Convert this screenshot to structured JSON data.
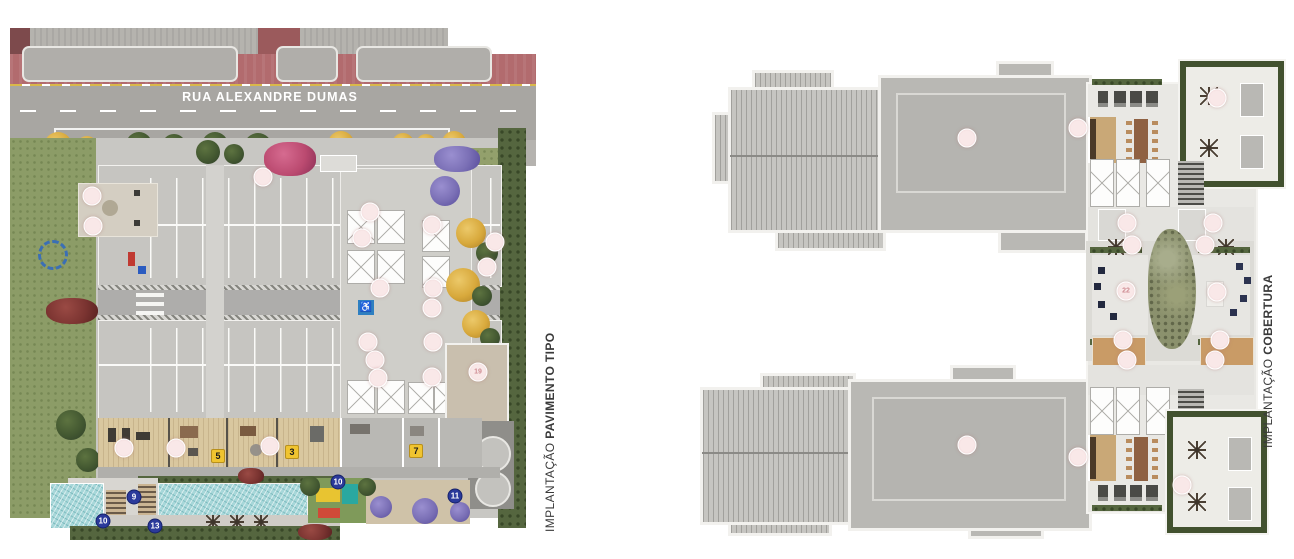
{
  "page": {
    "background": "#ffffff"
  },
  "left_plan": {
    "caption_regular": "IMPLANTAÇÃO",
    "caption_bold": "PAVIMENTO TIPO",
    "street_name": "RUA ALEXANDRE DUMAS",
    "markers": {
      "pink": [
        {
          "x": 82,
          "y": 168,
          "l": ""
        },
        {
          "x": 83,
          "y": 198,
          "l": ""
        },
        {
          "x": 253,
          "y": 149,
          "l": ""
        },
        {
          "x": 360,
          "y": 184,
          "l": ""
        },
        {
          "x": 352,
          "y": 210,
          "l": ""
        },
        {
          "x": 422,
          "y": 197,
          "l": ""
        },
        {
          "x": 485,
          "y": 214,
          "l": ""
        },
        {
          "x": 477,
          "y": 239,
          "l": ""
        },
        {
          "x": 370,
          "y": 260,
          "l": ""
        },
        {
          "x": 423,
          "y": 260,
          "l": ""
        },
        {
          "x": 422,
          "y": 280,
          "l": ""
        },
        {
          "x": 358,
          "y": 314,
          "l": ""
        },
        {
          "x": 423,
          "y": 314,
          "l": ""
        },
        {
          "x": 365,
          "y": 332,
          "l": ""
        },
        {
          "x": 368,
          "y": 350,
          "l": ""
        },
        {
          "x": 422,
          "y": 349,
          "l": ""
        },
        {
          "x": 114,
          "y": 420,
          "l": ""
        },
        {
          "x": 166,
          "y": 420,
          "l": ""
        },
        {
          "x": 260,
          "y": 418,
          "l": ""
        },
        {
          "x": 468,
          "y": 344,
          "l": "19"
        }
      ],
      "yellow": [
        {
          "x": 208,
          "y": 428,
          "l": "5"
        },
        {
          "x": 282,
          "y": 424,
          "l": "3"
        },
        {
          "x": 406,
          "y": 423,
          "l": "7"
        }
      ],
      "blue": [
        {
          "x": 124,
          "y": 469,
          "l": "9"
        },
        {
          "x": 93,
          "y": 493,
          "l": "10"
        },
        {
          "x": 145,
          "y": 498,
          "l": "13"
        },
        {
          "x": 328,
          "y": 454,
          "l": "10"
        },
        {
          "x": 445,
          "y": 468,
          "l": "11"
        }
      ]
    }
  },
  "right_plan": {
    "caption_regular": "IMPLANTAÇÃO",
    "caption_bold": "COBERTURA",
    "markers": {
      "pink": [
        {
          "x": 267,
          "y": 81,
          "l": ""
        },
        {
          "x": 378,
          "y": 71,
          "l": ""
        },
        {
          "x": 517,
          "y": 41,
          "l": ""
        },
        {
          "x": 432,
          "y": 188,
          "l": ""
        },
        {
          "x": 505,
          "y": 188,
          "l": ""
        },
        {
          "x": 427,
          "y": 166,
          "l": ""
        },
        {
          "x": 513,
          "y": 166,
          "l": ""
        },
        {
          "x": 426,
          "y": 234,
          "l": "22"
        },
        {
          "x": 517,
          "y": 235,
          "l": ""
        },
        {
          "x": 423,
          "y": 283,
          "l": ""
        },
        {
          "x": 520,
          "y": 283,
          "l": ""
        },
        {
          "x": 427,
          "y": 303,
          "l": ""
        },
        {
          "x": 515,
          "y": 303,
          "l": ""
        },
        {
          "x": 267,
          "y": 388,
          "l": ""
        },
        {
          "x": 378,
          "y": 400,
          "l": ""
        },
        {
          "x": 482,
          "y": 428,
          "l": ""
        }
      ]
    }
  },
  "colors": {
    "road": "#a8a6a2",
    "red_lane": "#b26b6e",
    "lawn": "#8c9c67",
    "pool": "#a7d7d9",
    "deck_wood": "#d9c79f",
    "marker_pink": "#f6e2e2",
    "marker_yellow": "#f0c430",
    "marker_blue": "#2b3a9b"
  }
}
